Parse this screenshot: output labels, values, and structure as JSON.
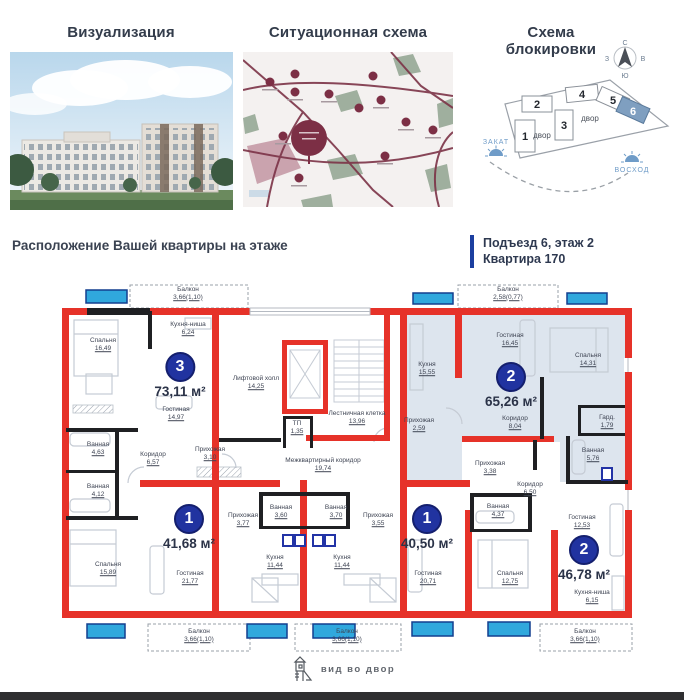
{
  "panels": {
    "visualization": {
      "title": "Визуализация"
    },
    "situational": {
      "title": "Ситуационная схема"
    },
    "blocking": {
      "title": "Схема блокировки",
      "compass": {
        "n": "С",
        "s": "Ю",
        "w": "З",
        "e": "В"
      },
      "blocks": [
        {
          "num": "1"
        },
        {
          "num": "2"
        },
        {
          "num": "3"
        },
        {
          "num": "4"
        },
        {
          "num": "5"
        },
        {
          "num": "6"
        }
      ],
      "highlighted_block": "6",
      "courtyard": [
        "двор",
        "двор"
      ],
      "sunset": "ЗАКАТ",
      "sunrise": "ВОСХОД"
    }
  },
  "location": {
    "heading": "Расположение Вашей квартиры на этаже",
    "entrance": "Подъезд 6, этаж 2",
    "apartment": "Квартира 170"
  },
  "plan": {
    "badges": [
      {
        "num": "3",
        "area": "73,11 м²"
      },
      {
        "num": "1",
        "area": "41,68 м²"
      },
      {
        "num": "1",
        "area": "40,50 м²"
      },
      {
        "num": "2",
        "area": "65,26 м²"
      },
      {
        "num": "2",
        "area": "46,78 м²"
      }
    ],
    "rooms": [
      {
        "label": "Балкон",
        "area": "3,66(1,10)"
      },
      {
        "label": "Спальня",
        "area": "16,49"
      },
      {
        "label": "Кухня-ниша",
        "area": "6,24"
      },
      {
        "label": "Лифтовой холл",
        "area": "14,25"
      },
      {
        "label": "Гостиная",
        "area": "14,97"
      },
      {
        "label": "Ванная",
        "area": "4,63"
      },
      {
        "label": "Коридор",
        "area": "6,57"
      },
      {
        "label": "Прихожая",
        "area": "3,10"
      },
      {
        "label": "ТП",
        "area": "1,35"
      },
      {
        "label": "Лестничная клетка",
        "area": "13,96"
      },
      {
        "label": "Межквартирный коридор",
        "area": "19,74"
      },
      {
        "label": "Ванная",
        "area": "4,12"
      },
      {
        "label": "Спальня",
        "area": "15,89"
      },
      {
        "label": "Гостиная",
        "area": "21,77"
      },
      {
        "label": "Балкон",
        "area": "3,66(1,10)"
      },
      {
        "label": "Прихожая",
        "area": "3,77"
      },
      {
        "label": "Ванная",
        "area": "3,60"
      },
      {
        "label": "Ванная",
        "area": "3,70"
      },
      {
        "label": "Прихожая",
        "area": "3,55"
      },
      {
        "label": "Кухня",
        "area": "11,44"
      },
      {
        "label": "Кухня",
        "area": "11,44"
      },
      {
        "label": "Балкон",
        "area": "3,66(1,10)"
      },
      {
        "label": "Кухня",
        "area": "15,55"
      },
      {
        "label": "Прихожая",
        "area": "2,59"
      },
      {
        "label": "Гостиная",
        "area": "16,45"
      },
      {
        "label": "Спальня",
        "area": "14,31"
      },
      {
        "label": "Коридор",
        "area": "8,04"
      },
      {
        "label": "Гард.",
        "area": "1,79"
      },
      {
        "label": "Ванная",
        "area": "5,76"
      },
      {
        "label": "Балкон",
        "area": "2,58(0,77)"
      },
      {
        "label": "Прихожая",
        "area": "3,38"
      },
      {
        "label": "Коридор",
        "area": "6,50"
      },
      {
        "label": "Ванная",
        "area": "4,37"
      },
      {
        "label": "Гостиная",
        "area": "20,71"
      },
      {
        "label": "Спальня",
        "area": "12,75"
      },
      {
        "label": "Гостиная",
        "area": "12,53"
      },
      {
        "label": "Кухня-ниша",
        "area": "6,15"
      },
      {
        "label": "Балкон",
        "area": "3,66(1,10)"
      }
    ]
  },
  "footer": {
    "view": "вид во двор"
  },
  "colors": {
    "wall_red": "#e63229",
    "window_blue": "#30a8dd",
    "badge_blue": "#2133a0",
    "highlight": "#dde5ee"
  }
}
